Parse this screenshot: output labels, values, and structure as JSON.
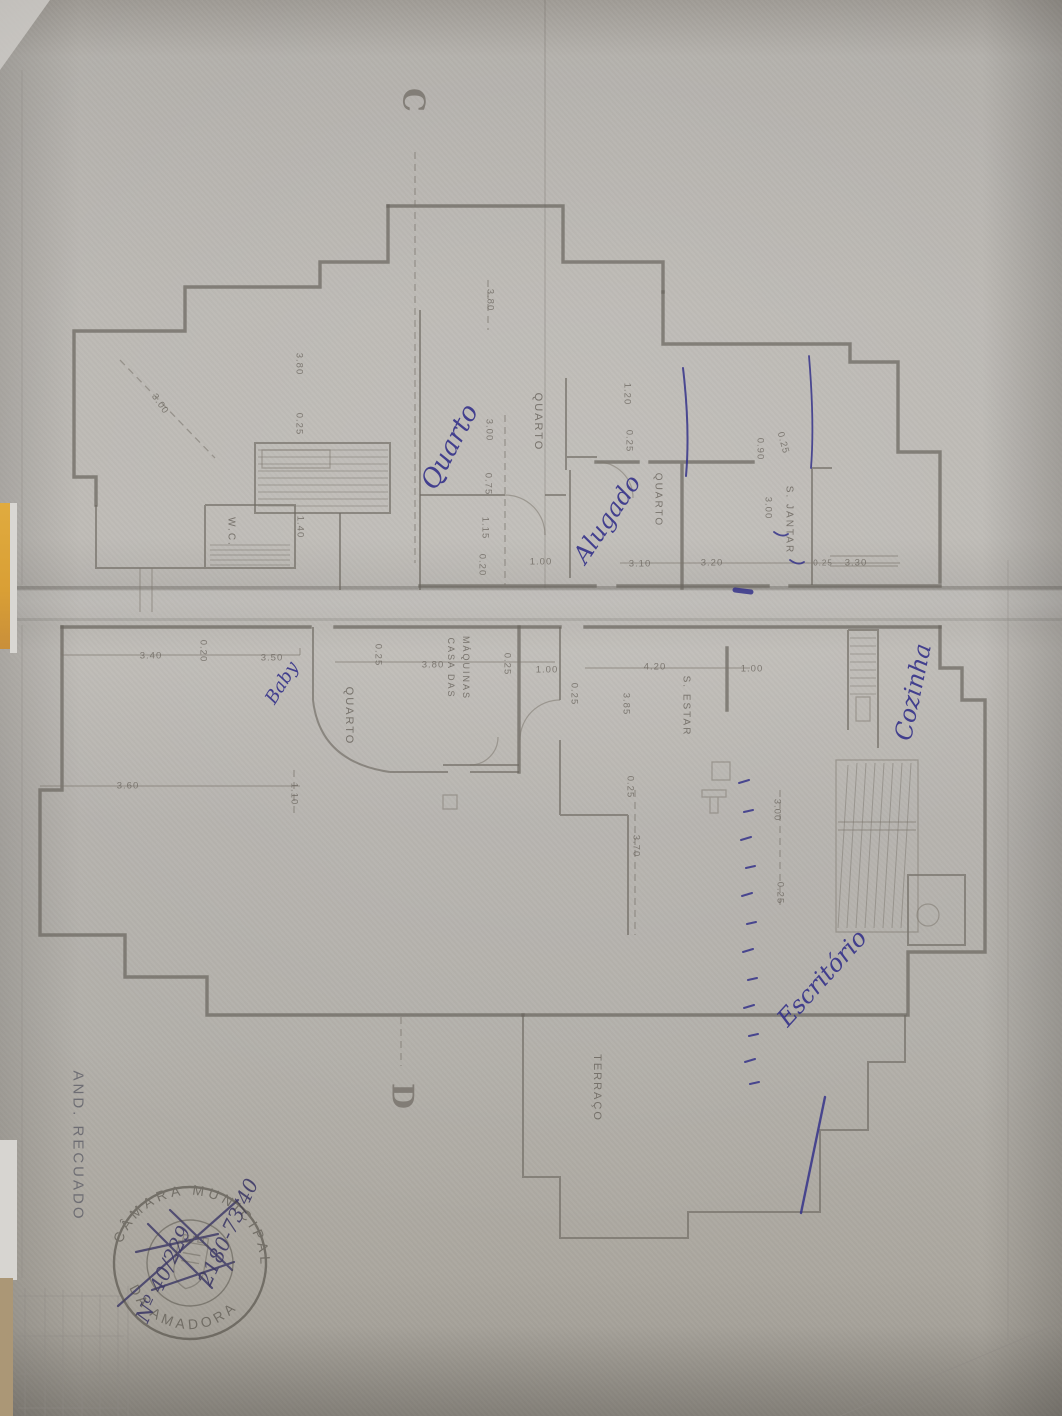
{
  "plan": {
    "floor_note": {
      "text": "AND. RECUADO",
      "x": 78,
      "y": 1146,
      "rot": 90
    },
    "section_markers": [
      {
        "text": "C",
        "x": 413,
        "y": 100,
        "rot": 90
      },
      {
        "text": "D",
        "x": 402,
        "y": 1096,
        "rot": 90
      }
    ],
    "room_labels": [
      {
        "text": "QUARTO",
        "x": 538,
        "y": 422,
        "rot": 90
      },
      {
        "text": "QUARTO",
        "x": 658,
        "y": 500,
        "rot": 90,
        "size": 10
      },
      {
        "text": "QUARTO",
        "x": 349,
        "y": 716,
        "rot": 90
      },
      {
        "text": "W.C.",
        "x": 231,
        "y": 532,
        "rot": 90,
        "size": 10
      },
      {
        "text": "S. JANTAR",
        "x": 789,
        "y": 520,
        "rot": 90,
        "size": 10
      },
      {
        "text": "S. ESTAR",
        "x": 686,
        "y": 706,
        "rot": 90,
        "size": 10
      },
      {
        "text": "CASA DAS",
        "x": 451,
        "y": 668,
        "rot": 90,
        "size": 9
      },
      {
        "text": "MÁQUINAS",
        "x": 466,
        "y": 668,
        "rot": 90,
        "size": 9
      },
      {
        "text": "TERRAÇO",
        "x": 597,
        "y": 1088,
        "rot": 90
      }
    ],
    "dimension_labels": [
      {
        "text": "3.00",
        "x": 160,
        "y": 404,
        "rot": 55
      },
      {
        "text": "3.80",
        "x": 299,
        "y": 364,
        "rot": 90
      },
      {
        "text": "0.25",
        "x": 299,
        "y": 424,
        "rot": 90
      },
      {
        "text": "3.80",
        "x": 490,
        "y": 300,
        "rot": 90
      },
      {
        "text": "3.00",
        "x": 489,
        "y": 430,
        "rot": 90
      },
      {
        "text": "0.75",
        "x": 488,
        "y": 484,
        "rot": 90
      },
      {
        "text": "1.15",
        "x": 485,
        "y": 528,
        "rot": 90
      },
      {
        "text": "0.20",
        "x": 482,
        "y": 565,
        "rot": 90
      },
      {
        "text": "1.00",
        "x": 541,
        "y": 562,
        "rot": 0
      },
      {
        "text": "1.40",
        "x": 300,
        "y": 527,
        "rot": 90
      },
      {
        "text": "1.20",
        "x": 627,
        "y": 394,
        "rot": 90
      },
      {
        "text": "0.25",
        "x": 629,
        "y": 441,
        "rot": 90
      },
      {
        "text": "0.90",
        "x": 760,
        "y": 449,
        "rot": 90
      },
      {
        "text": "0.25",
        "x": 783,
        "y": 443,
        "rot": 75
      },
      {
        "text": "3.00",
        "x": 768,
        "y": 508,
        "rot": 90
      },
      {
        "text": "3.10",
        "x": 640,
        "y": 564,
        "rot": 0
      },
      {
        "text": "3.20",
        "x": 712,
        "y": 563,
        "rot": 0
      },
      {
        "text": "0.25",
        "x": 823,
        "y": 563,
        "rot": 0,
        "size": 8
      },
      {
        "text": "3.30",
        "x": 856,
        "y": 563,
        "rot": 0
      },
      {
        "text": "3.40",
        "x": 151,
        "y": 656,
        "rot": 0
      },
      {
        "text": "0.20",
        "x": 203,
        "y": 651,
        "rot": 90
      },
      {
        "text": "3.50",
        "x": 272,
        "y": 658,
        "rot": 0
      },
      {
        "text": "0.25",
        "x": 378,
        "y": 655,
        "rot": 90
      },
      {
        "text": "3.80",
        "x": 433,
        "y": 665,
        "rot": 0
      },
      {
        "text": "0.25",
        "x": 507,
        "y": 664,
        "rot": 90
      },
      {
        "text": "1.00",
        "x": 547,
        "y": 670,
        "rot": 0
      },
      {
        "text": "0.25",
        "x": 574,
        "y": 694,
        "rot": 90
      },
      {
        "text": "4.20",
        "x": 655,
        "y": 667,
        "rot": 0
      },
      {
        "text": "1.00",
        "x": 752,
        "y": 669,
        "rot": 0
      },
      {
        "text": "3.85",
        "x": 626,
        "y": 704,
        "rot": 90
      },
      {
        "text": "0.25",
        "x": 630,
        "y": 787,
        "rot": 90
      },
      {
        "text": "3.70",
        "x": 636,
        "y": 846,
        "rot": 90
      },
      {
        "text": "3.00",
        "x": 777,
        "y": 810,
        "rot": 90
      },
      {
        "text": "0.25",
        "x": 780,
        "y": 893,
        "rot": 90
      },
      {
        "text": "3.60",
        "x": 128,
        "y": 786,
        "rot": 0
      },
      {
        "text": "1.10",
        "x": 294,
        "y": 794,
        "rot": 90
      }
    ]
  },
  "handwriting": {
    "ink_color": "#35328a",
    "notes": [
      {
        "text": "Quarto",
        "x": 450,
        "y": 447,
        "rot": -62,
        "size": 26
      },
      {
        "text": "Alugado",
        "x": 607,
        "y": 519,
        "rot": -56,
        "size": 24
      },
      {
        "text": "Cozinha",
        "x": 913,
        "y": 692,
        "rot": -78,
        "size": 24
      },
      {
        "text": "Escritório",
        "x": 822,
        "y": 978,
        "rot": -48,
        "size": 24
      },
      {
        "text": "Baby",
        "x": 282,
        "y": 683,
        "rot": -58,
        "size": 18
      }
    ]
  },
  "stamp": {
    "arc_top": "CÂMARA MUNICIPAL",
    "arc_bottom": "DA AMADORA",
    "overwrite_lines": [
      {
        "text": "2180-73/40",
        "x": 228,
        "y": 1232,
        "rot": -65,
        "size": 20
      },
      {
        "text": "Nº 40/229",
        "x": 163,
        "y": 1274,
        "rot": -65,
        "size": 20
      }
    ]
  },
  "palette": {
    "paper": "#b5b2ad",
    "plan_line": "#6b665f",
    "ink": "#35328a",
    "stamp": "#4b473f",
    "desk": "#ab9776",
    "yellow_strip": "#d99f35"
  }
}
